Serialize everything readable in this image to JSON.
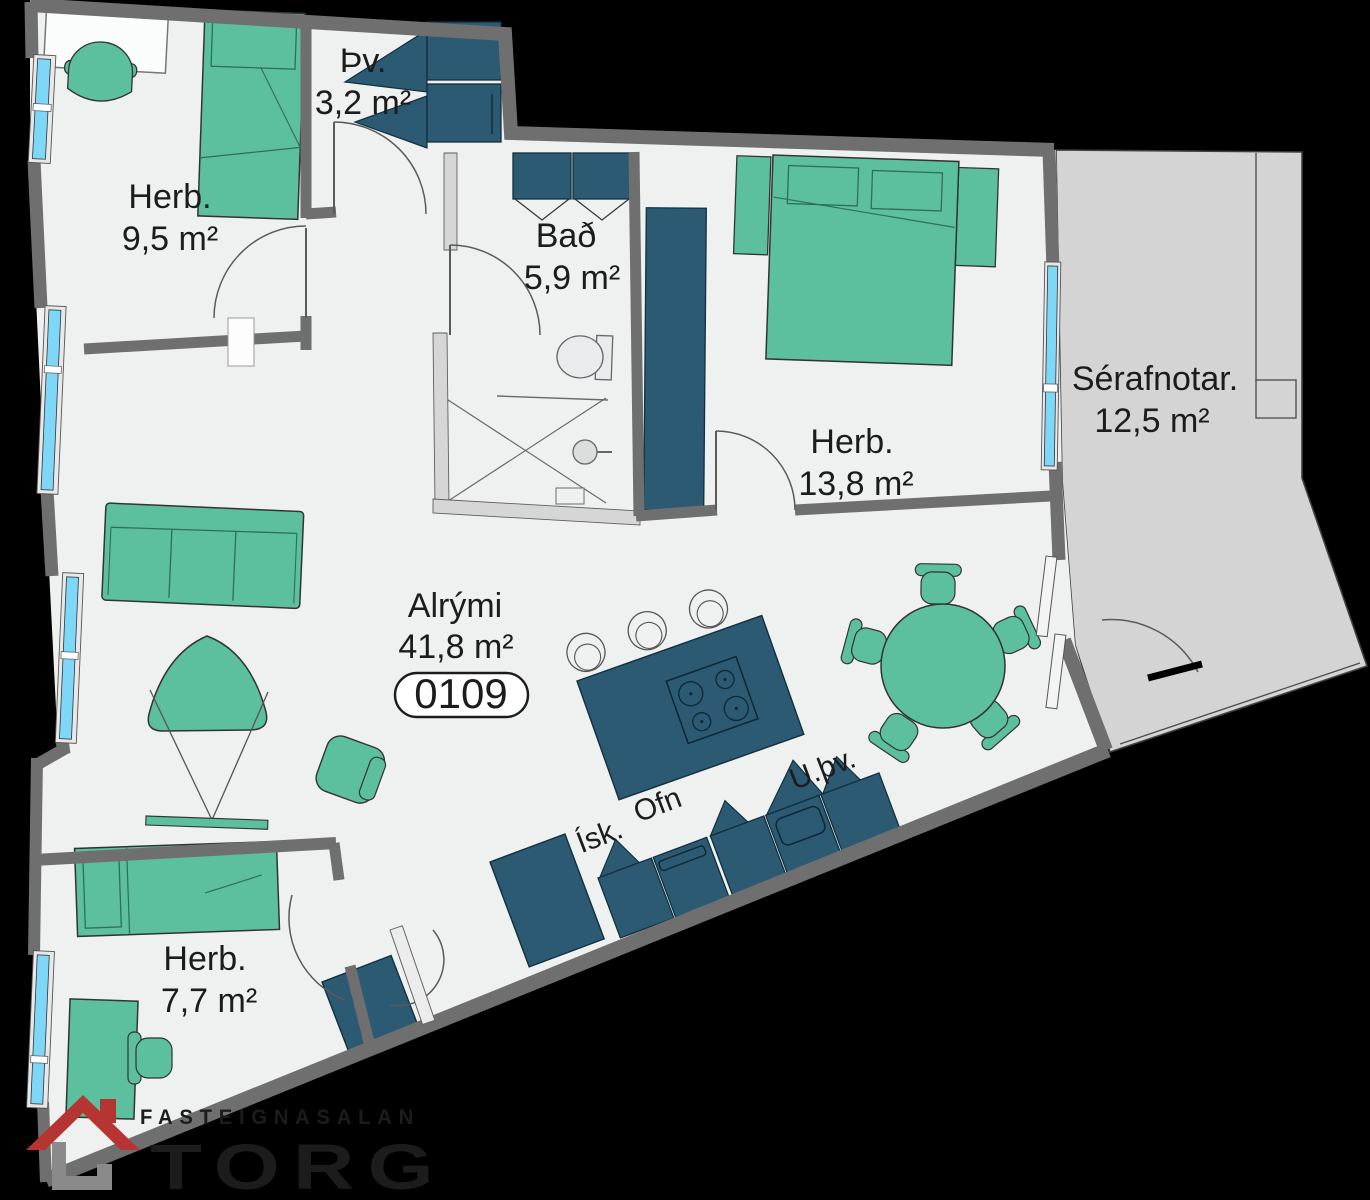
{
  "meta": {
    "background": "#000000",
    "floor_fill": "#eef1f0",
    "terrace_fill": "#d3d4d3",
    "wall_color": "#6f6f6f",
    "light_wall_color": "#d6d6d6",
    "furniture_green": "#5cbf9e",
    "furniture_navy": "#2b5a72",
    "window_blue": "#7fd7f7",
    "text_color": "#1c1c1c"
  },
  "unit": {
    "number": "0109"
  },
  "rooms": [
    {
      "id": "herb-9-5",
      "name": "Herb.",
      "area": "9,5 m²"
    },
    {
      "id": "thvottur",
      "name": "Þv.",
      "area": "3,2 m²"
    },
    {
      "id": "bad",
      "name": "Bað",
      "area": "5,9 m²"
    },
    {
      "id": "herb-13-8",
      "name": "Herb.",
      "area": "13,8 m²"
    },
    {
      "id": "serafnotar",
      "name": "Sérafnotar.",
      "area": "12,5 m²"
    },
    {
      "id": "alrymi",
      "name": "Alrými",
      "area": "41,8 m²"
    },
    {
      "id": "herb-7-7",
      "name": "Herb.",
      "area": "7,7 m²"
    }
  ],
  "kitchen": {
    "fridge_label": "Ísk.",
    "oven_label": "Ofn",
    "dishwasher_label": "U.þv."
  },
  "logo": {
    "top_text": "FASTEIGNASALAN",
    "name": "TORG",
    "red": "#b63532",
    "gray": "#7f7f7f"
  }
}
